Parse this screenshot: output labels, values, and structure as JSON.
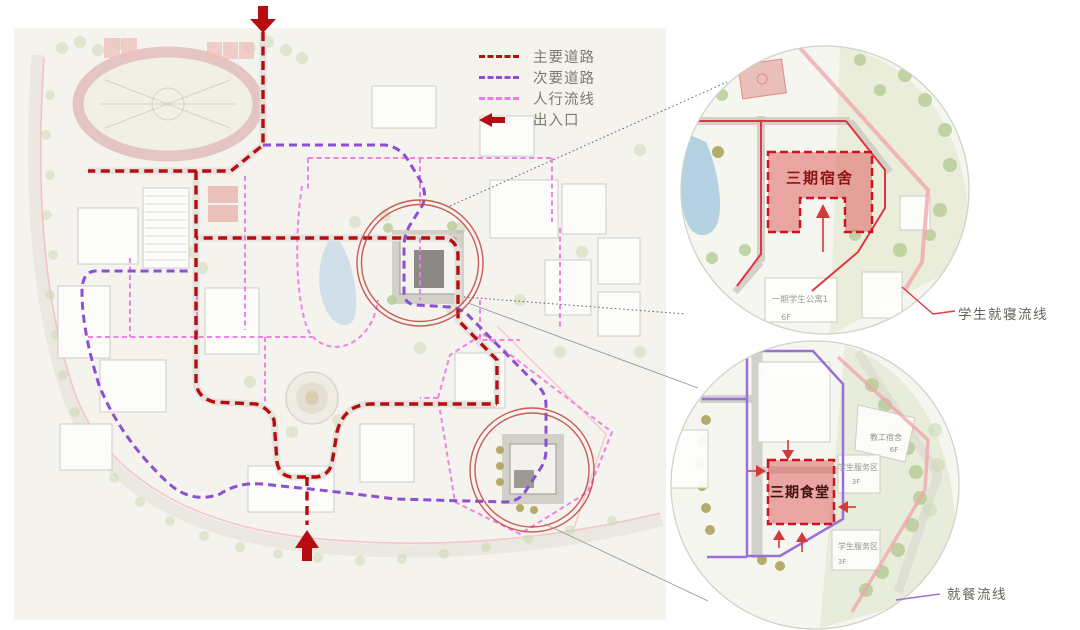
{
  "legend": {
    "items": [
      {
        "id": "main-road",
        "label": "主要道路"
      },
      {
        "id": "secondary-road",
        "label": "次要道路"
      },
      {
        "id": "pedestrian-flow",
        "label": "人行流线"
      },
      {
        "id": "entrance",
        "label": "出入口"
      }
    ]
  },
  "callouts": {
    "dorm": {
      "building_title": "三期宿舍",
      "flow_label": "学生就寝流线",
      "context_buildings": [
        {
          "name": "一期学生公寓1",
          "floor": "6F"
        }
      ]
    },
    "canteen": {
      "building_title": "三期食堂",
      "flow_label": "就餐流线",
      "context_buildings": [
        {
          "name": "教工宿舍",
          "floor": "6F"
        },
        {
          "name": "学生服务区",
          "floor": "3F"
        },
        {
          "name": "学生服务区",
          "floor": "3F"
        }
      ]
    }
  },
  "colors": {
    "main_road": "#b70d11",
    "secondary_road": "#8d4fd3",
    "pedestrian_flow": "#ee7ce4",
    "entrance_arrow": "#b70d11",
    "sleep_flow_line": "#e23c46",
    "dining_flow_line": "#9a6fd8",
    "highlight_fill": "#de5555",
    "highlight_border": "#cf1420"
  }
}
